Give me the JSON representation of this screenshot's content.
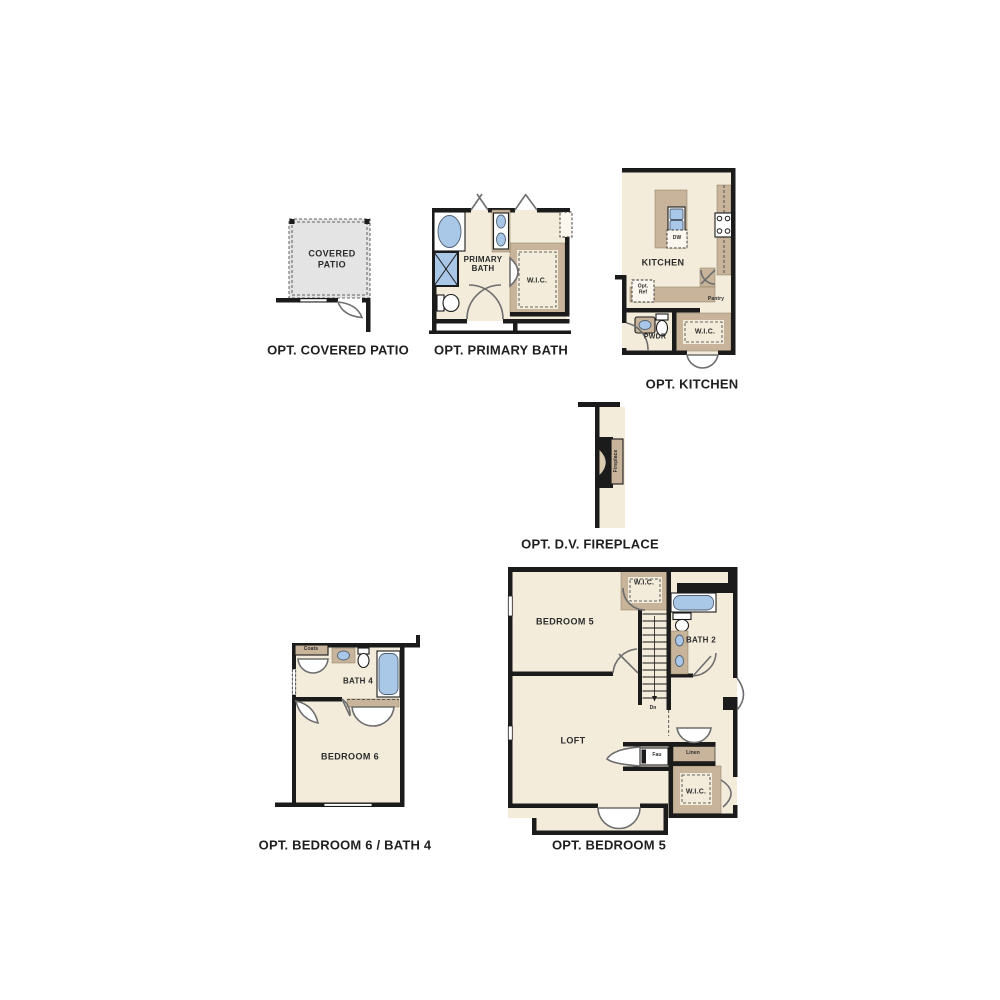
{
  "colors": {
    "wall": "#1b1b1b",
    "floor": "#f3ecdb",
    "counter": "#c8b49a",
    "fixture": "#a9c7e7",
    "patio": "#e4e4e4",
    "door": "#6e6e6e",
    "text": "#2b2b2b"
  },
  "plans": {
    "covered_patio": {
      "caption": "OPT. COVERED PATIO",
      "room": "COVERED PATIO"
    },
    "primary_bath": {
      "caption": "OPT. PRIMARY BATH",
      "room": "PRIMARY BATH",
      "wic": "W.I.C."
    },
    "kitchen": {
      "caption": "OPT. KITCHEN",
      "room": "KITCHEN",
      "dw": "DW",
      "opt_ref": "Opt. Ref",
      "pantry": "Pantry",
      "pwdr": "PWDR",
      "wic": "W.I.C."
    },
    "fireplace": {
      "caption": "OPT. D.V. FIREPLACE",
      "unit": "Fireplace"
    },
    "bedroom6": {
      "caption": "OPT. BEDROOM 6 / BATH 4",
      "room": "BEDROOM 6",
      "bath": "BATH 4",
      "coats": "Coats"
    },
    "bedroom5": {
      "caption": "OPT. BEDROOM 5",
      "room": "BEDROOM 5",
      "loft": "LOFT",
      "bath": "BATH 2",
      "wic_upper": "W.I.C.",
      "wic_lower": "W.I.C.",
      "linen": "Linen",
      "fau": "Fau",
      "dn": "Dn"
    }
  }
}
